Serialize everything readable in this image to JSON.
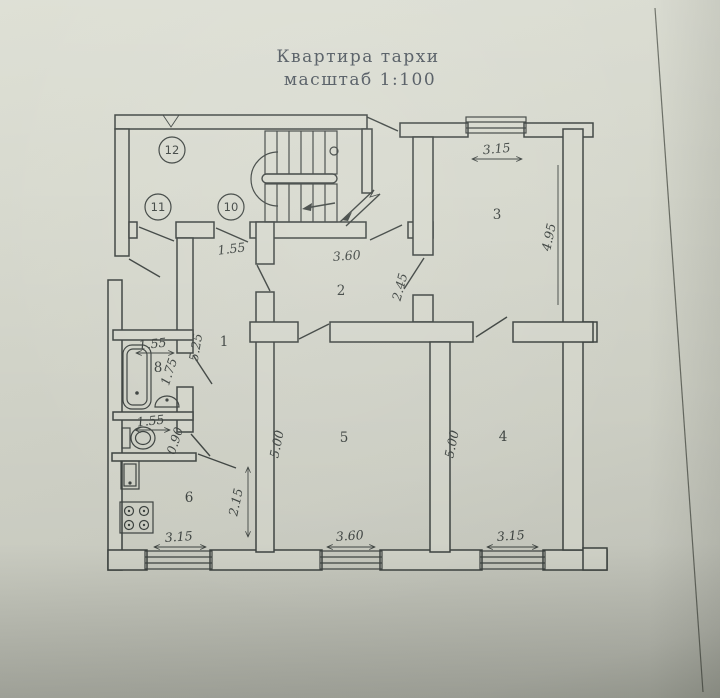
{
  "title": {
    "line1": "Квартира тархи",
    "line2": "масштаб 1:100"
  },
  "colors": {
    "paper": "#d6d8cd",
    "ink": "#3d4340",
    "title_text": "#4b535b"
  },
  "rooms": {
    "r1": "1",
    "r2": "2",
    "r3": "3",
    "r4": "4",
    "r5": "5",
    "r6": "6",
    "r8": "8"
  },
  "circles": {
    "c10": "10",
    "c11": "11",
    "c12": "12"
  },
  "dims": {
    "hall_width": "1.55",
    "room2_width": "3.60",
    "room2_depth": "2.45",
    "room3_width": "3.15",
    "room3_depth": "4.95",
    "corridor_len": "5.25",
    "bath_width": "1.55",
    "bath_depth": "1.75",
    "wc_width": "1.55",
    "wc_depth": "0.90",
    "kitchen_width": "3.15",
    "kitchen_depth": "2.15",
    "room5_width": "3.60",
    "room5_depth": "5.00",
    "room4_width": "3.15",
    "room4_depth": "5.00"
  }
}
